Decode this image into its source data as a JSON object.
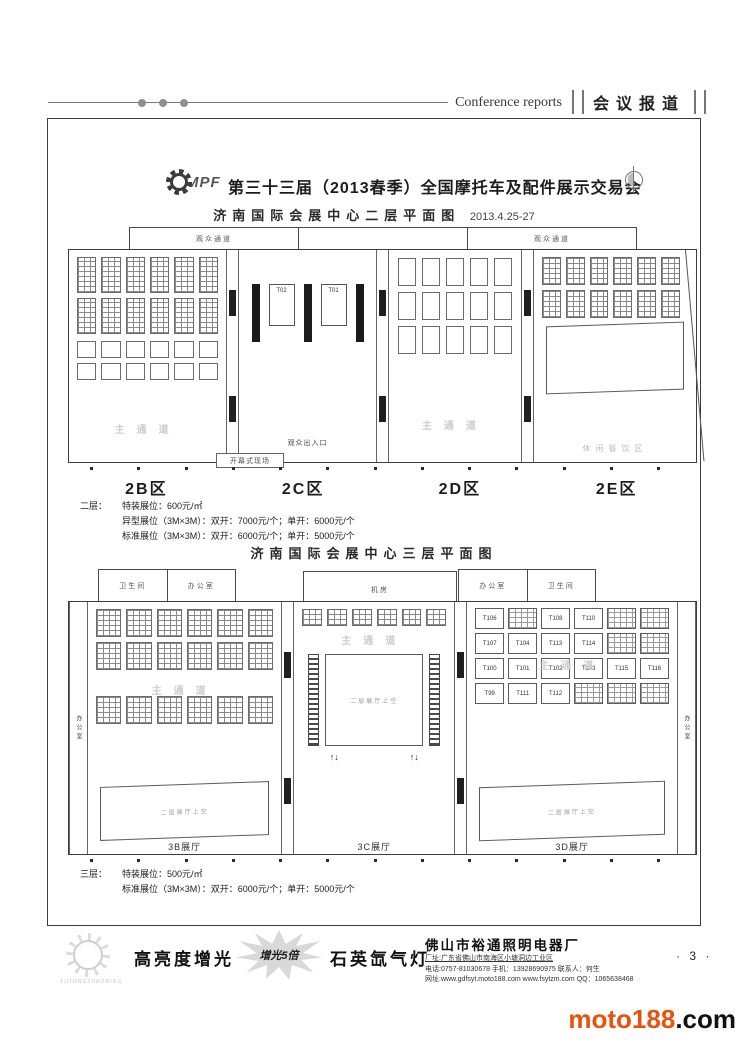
{
  "header": {
    "report_label_en": "Conference reports",
    "report_label_zh": "会议报道"
  },
  "doc": {
    "logo_text": "MPF",
    "title": "第三十三届（2013春季）全国摩托车及配件展示交易会",
    "floor2": {
      "subtitle": "济南国际会展中心二层平面图",
      "date": "2013.4.25-27",
      "corridor_left": "观众通道",
      "corridor_right": "观众通道",
      "main_entrance": "主入口",
      "audience_gate": "观众出入口",
      "opening_site": "开幕式现场",
      "leisure_zone": "休闲餐饮区",
      "main_aisle": "主通道",
      "center_booths": [
        "T02",
        "T01"
      ],
      "zones": [
        "2B区",
        "2C区",
        "2D区",
        "2E区"
      ],
      "price_label": "二层：",
      "price_lines": [
        "特装展位：600元/㎡",
        "异型展位（3M×3M）：双开：7000元/个；单开：6000元/个",
        "标准展位（3M×3M）：双开：6000元/个；单开：5000元/个"
      ]
    },
    "floor3": {
      "subtitle": "济南国际会展中心三层平面图",
      "rooms_left": [
        "卫生间",
        "办公室"
      ],
      "rooms_center": [
        "机房"
      ],
      "rooms_right": [
        "办公室",
        "卫生间"
      ],
      "office_side": "办公室",
      "main_aisle": "主通道",
      "void_label": "二层展厅上空",
      "escalator_glyph": "↑↓",
      "booths": [
        "T106",
        "",
        "T108",
        "T110",
        "",
        "",
        "T107",
        "T104",
        "T113",
        "T114",
        "",
        "",
        "T100",
        "T101",
        "T102",
        "T103",
        "T115",
        "T116",
        "T99",
        "T111",
        "T112",
        "",
        "",
        ""
      ],
      "hall_3b": "3B展厅",
      "hall_3c": "3C展厅",
      "hall_3d": "3D展厅",
      "price_label": "三层：",
      "price_lines": [
        "特装展位：500元/㎡",
        "标准展位（3M×3M）：双开：6000元/个；单开：5000元/个"
      ]
    }
  },
  "footer": {
    "logo_caption": "YUTONGZHAOMING",
    "slogan_left": "高亮度增光",
    "burst_text": "增光5倍",
    "slogan_right": "石英氙气灯",
    "company_name": "佛山市裕通照明电器厂",
    "company_lines": [
      "厂址:广东省佛山市南海区小塘洞边工业区",
      "电话:0757-81030678  手机：13928690975  联系人：何生",
      "网址:www.gdfsyt.moto188.com  www.fsytzm.com  QQ：1065638468"
    ],
    "page_number": "· 3 ·"
  },
  "watermark": {
    "brand": "moto188",
    "suffix": ".com",
    "brand_color": "#e8520a"
  }
}
